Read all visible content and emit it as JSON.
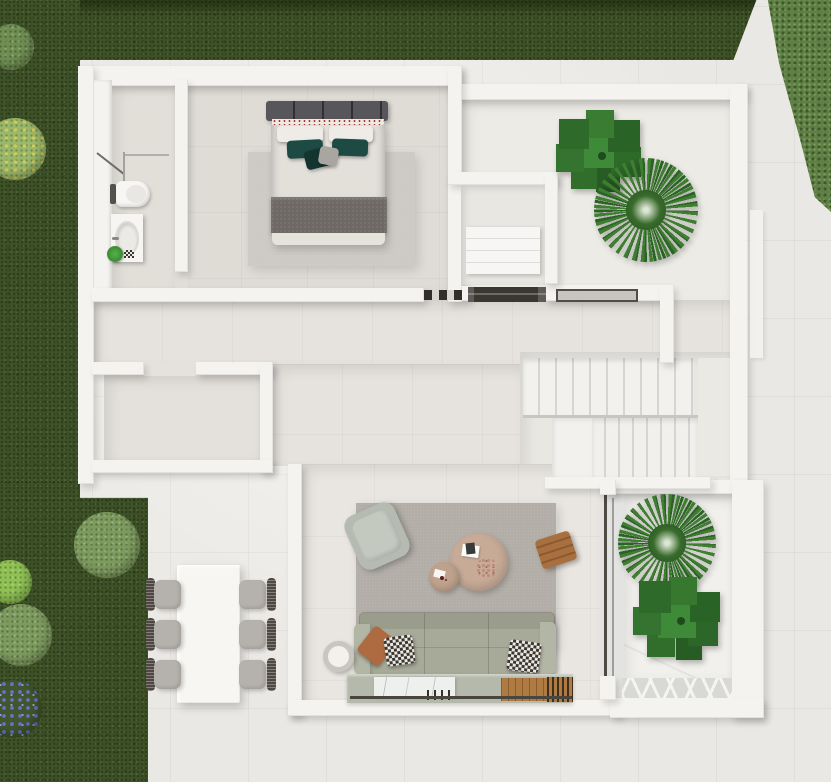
{
  "scene": {
    "type": "3d-floor-plan-top-down-render",
    "visible_text": [],
    "rooms": [
      "garden-lawn",
      "outdoor-terrace",
      "bathroom",
      "bedroom",
      "indoor-patio-wardrobe",
      "entrance-hall",
      "storage-room",
      "staircase",
      "living-room",
      "courtyard-planter",
      "outdoor-dining-area"
    ],
    "furniture": [
      "double-bed",
      "bedroom-rug",
      "toilet",
      "vanity-sink",
      "shower",
      "wardrobe-linen-shelf",
      "entrance-door-threshold",
      "entrance-mat",
      "sofa-3-seat",
      "armchair",
      "coffee-table-large",
      "coffee-table-small",
      "wooden-slat-stool",
      "round-side-table",
      "media-deck-sideboard",
      "living-rug",
      "dining-table",
      "dining-chairs-x6",
      "staircase-two-flights"
    ],
    "plants": [
      "fiddle-leaf-plant-patio",
      "palm-plant-patio",
      "palm-plant-courtyard",
      "fiddle-leaf-plant-courtyard",
      "garden-bushes-x5",
      "blue-flower-patch",
      "yellow-flower-bush"
    ]
  },
  "palette": {
    "grass": "#3d5126",
    "grass-dark": "#2c3e1b",
    "hedge": "#5e7f45",
    "bush-sage": "#7d9b5e",
    "bush-bright": "#8fc153",
    "flower-yellow": "#d9c94f",
    "flower-blue": "#6272c8",
    "terrace": "#eae8e4",
    "wall": "#f4f3f0",
    "floor-warm": "#e6e3de",
    "floor-bath": "#e2dfd9",
    "floor-bed": "#dfdcd6",
    "marble": "#f1f0ec",
    "rug-bedroom": "#ccc9c3",
    "rug-living": "#b1aca5",
    "sofa": "#a7aa98",
    "headboard": "#57565a",
    "blanket": "#6e6964",
    "teal": "#1d4a43",
    "table-tan": "#c7ab97",
    "wood": "#a86f3f",
    "chair-seat": "#b5b1ac",
    "chair-back": "#4f4842",
    "door-dark": "#3a3632",
    "leaf-dark": "#2a6326",
    "leaf-mid": "#3f7e31"
  }
}
